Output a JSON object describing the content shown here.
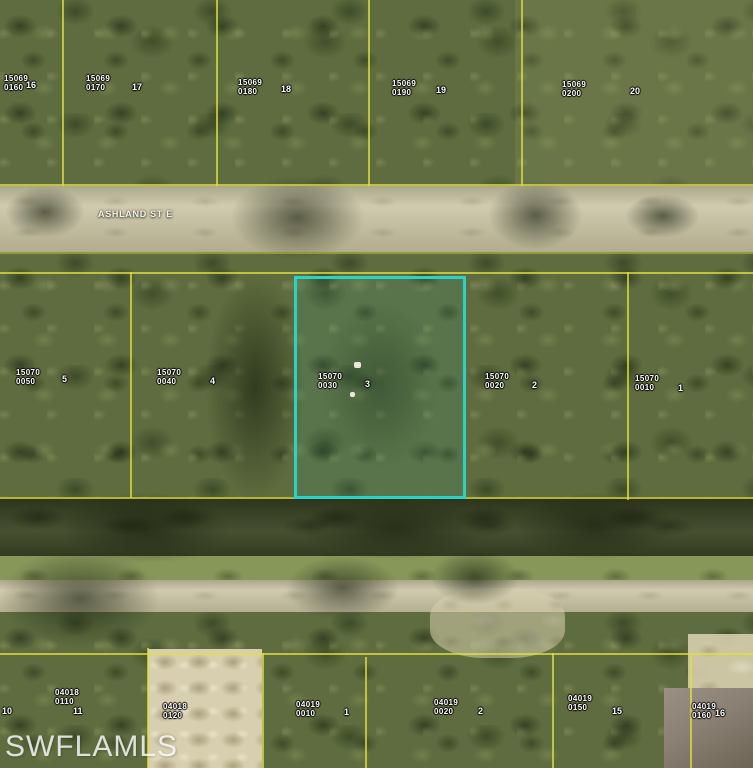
{
  "watermark": "SWFLAMLS",
  "street": {
    "name": "ASHLAND ST E"
  },
  "colors": {
    "highlight": "#2bd3c7",
    "parcel_line": "#e0e03e",
    "label_text": "#ffffff"
  },
  "highlighted_parcel": {
    "block": "15070",
    "lot_code": "0030",
    "lot": "3"
  },
  "parcels": {
    "north": [
      {
        "block": "15069",
        "lot_code": "0160",
        "lot": "16"
      },
      {
        "block": "15069",
        "lot_code": "0170",
        "lot": "17"
      },
      {
        "block": "15069",
        "lot_code": "0180",
        "lot": "18"
      },
      {
        "block": "15069",
        "lot_code": "0190",
        "lot": "19"
      },
      {
        "block": "15069",
        "lot_code": "0200",
        "lot": "20"
      }
    ],
    "middle": [
      {
        "block": "15070",
        "lot_code": "0050",
        "lot": "5"
      },
      {
        "block": "15070",
        "lot_code": "0040",
        "lot": "4"
      },
      {
        "block": "15070",
        "lot_code": "0030",
        "lot": "3"
      },
      {
        "block": "15070",
        "lot_code": "0020",
        "lot": "2"
      },
      {
        "block": "15070",
        "lot_code": "0010",
        "lot": "1"
      }
    ],
    "south": [
      {
        "block": "04018",
        "lot_code": "0110",
        "lot": "11"
      },
      {
        "block": "04018",
        "lot_code": "0120",
        "lot": ""
      },
      {
        "block": "04019",
        "lot_code": "0010",
        "lot": "1"
      },
      {
        "block": "04019",
        "lot_code": "0020",
        "lot": "2"
      },
      {
        "block": "04019",
        "lot_code": "0150",
        "lot": "15"
      },
      {
        "block": "04019",
        "lot_code": "0160",
        "lot": "16"
      }
    ],
    "south_edge_lot": "10"
  }
}
